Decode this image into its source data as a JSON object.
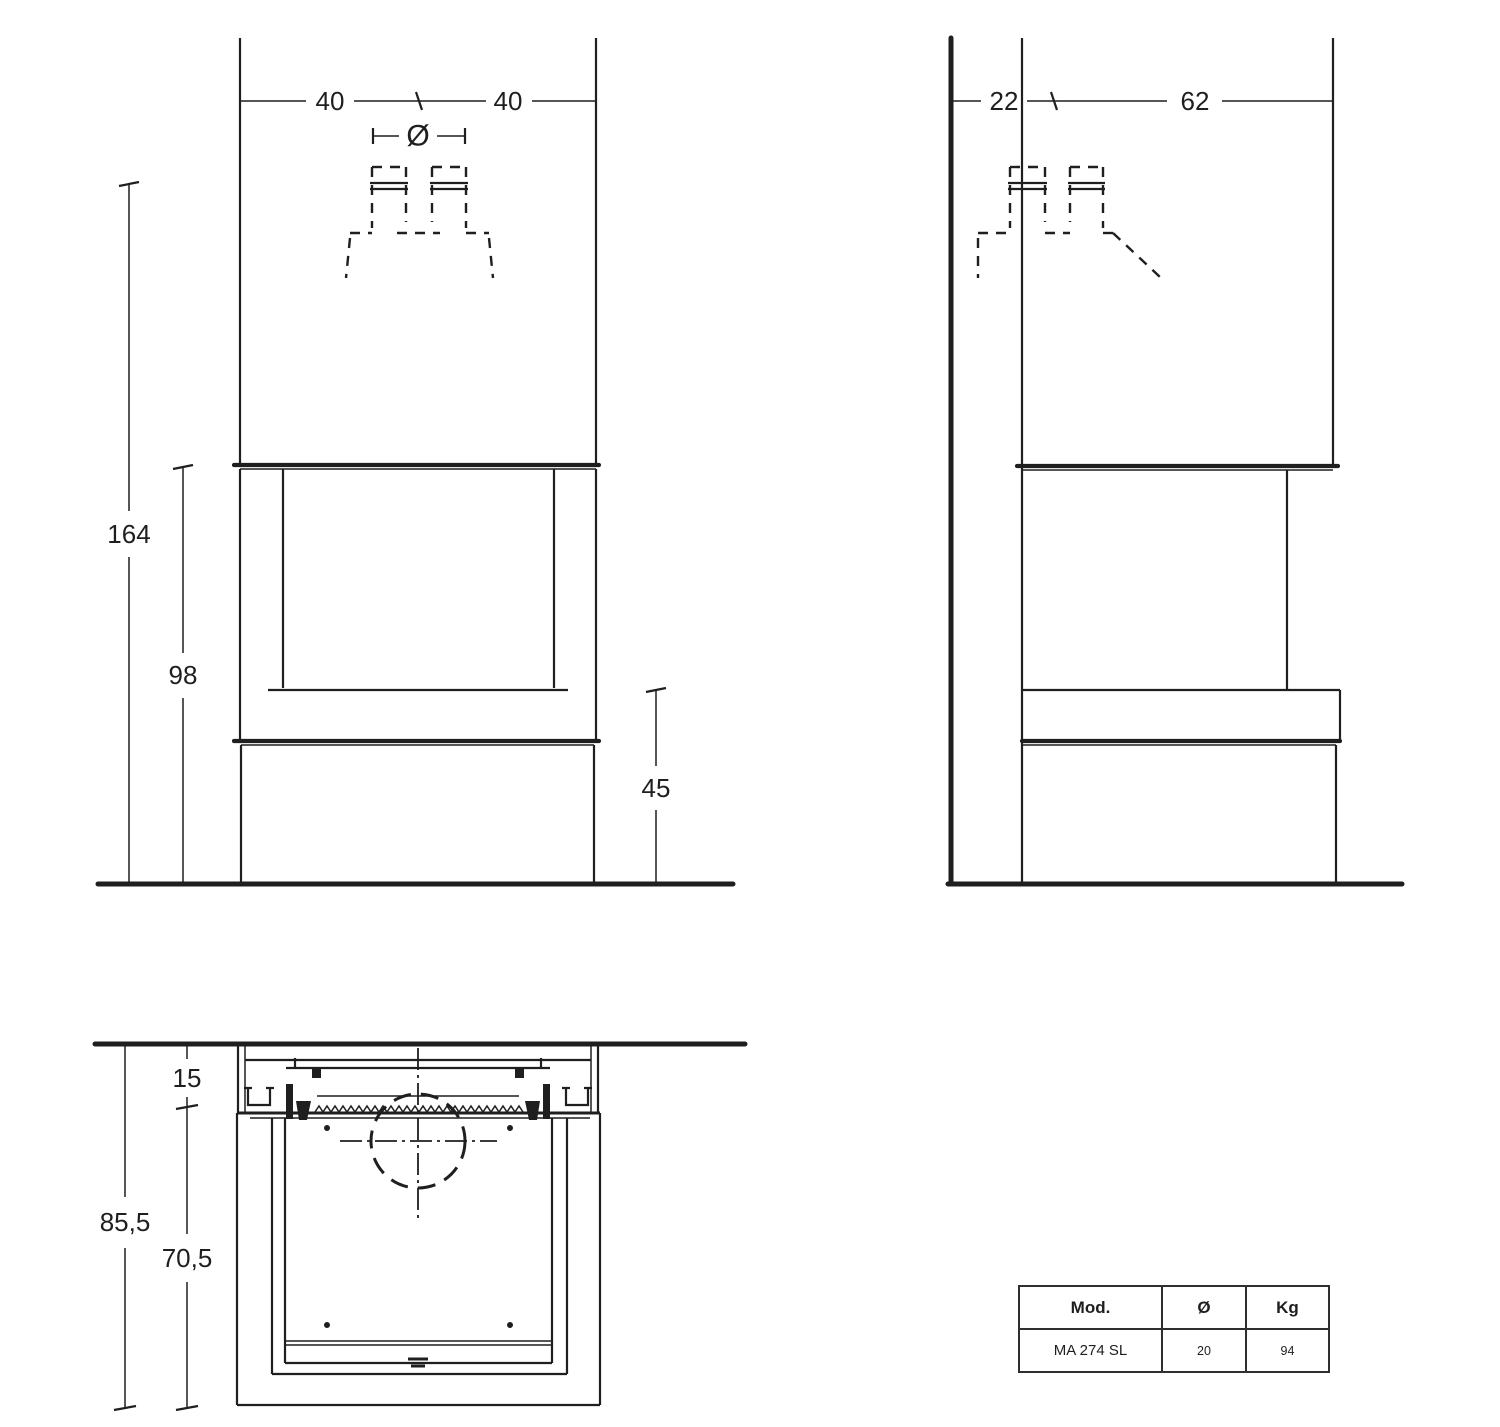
{
  "front_view": {
    "dim_width_left": "40",
    "dim_width_right": "40",
    "dim_flue_diameter": "Ø",
    "dim_total_height": "164",
    "dim_opening_height": "98",
    "dim_bench_height": "45"
  },
  "side_view": {
    "dim_rear_depth": "22",
    "dim_front_depth": "62"
  },
  "plan_view": {
    "dim_wall_offset": "15",
    "dim_total_depth": "85,5",
    "dim_body_depth": "70,5"
  },
  "spec_table": {
    "col_model": "Mod.",
    "col_diameter": "Ø",
    "col_weight": "Kg",
    "row_model": "MA 274 SL",
    "row_diameter": "20",
    "row_weight": "94"
  }
}
